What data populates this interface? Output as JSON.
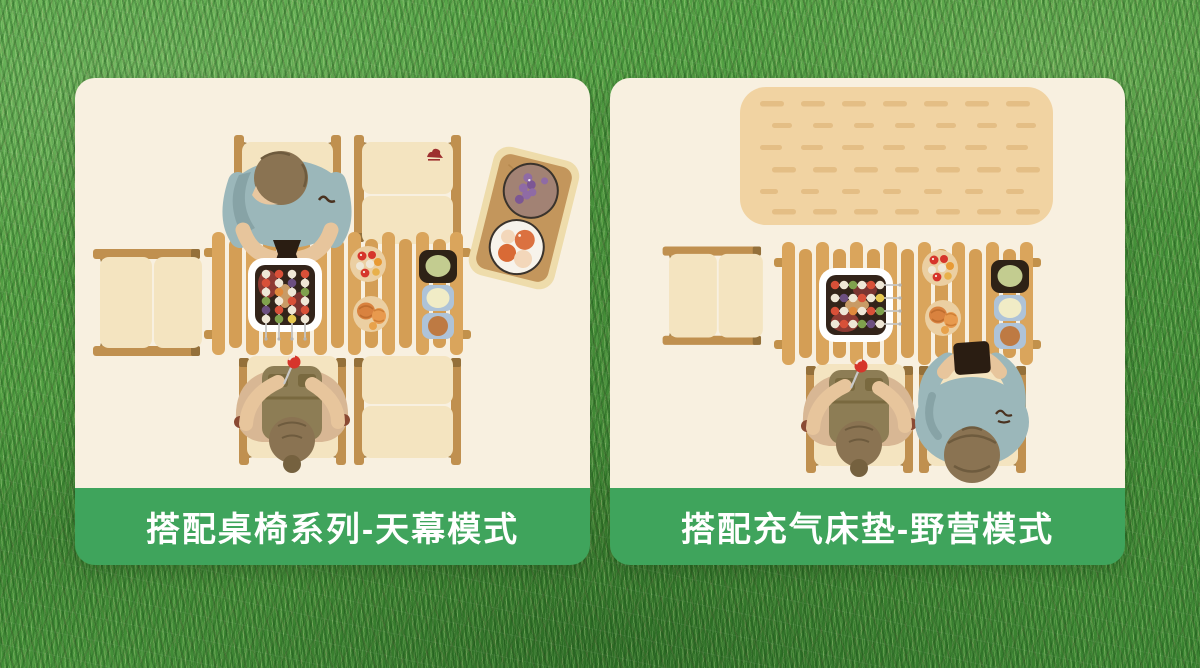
{
  "cards": [
    {
      "id": "canopy-mode",
      "caption": "搭配桌椅系列-天幕模式",
      "scene_items": [
        "occupied-camp-chair-top",
        "empty-camp-chair-top-right",
        "side-folding-chair",
        "slatted-camp-table",
        "bbq-grill-skewers",
        "cherry-tomato-plate",
        "bread-plate",
        "side-dish-trio",
        "wooden-tray-grapes-oranges",
        "diner-with-fork",
        "empty-camp-chair-bottom-right",
        "camel-logo"
      ]
    },
    {
      "id": "camping-mode",
      "caption": "搭配充气床垫-野营模式",
      "scene_items": [
        "inflatable-mattress",
        "side-folding-chair",
        "slatted-camp-table",
        "bbq-grill-skewers",
        "cherry-tomato-plate",
        "bread-plate",
        "side-dish-trio",
        "diner-with-fork",
        "person-using-phone",
        "camel-logo"
      ]
    }
  ],
  "colors": {
    "banner_green": "#3FA45C",
    "panel_cream": "#F8F0E0",
    "grass_green": "#4E9C40",
    "wood_light": "#DAA55C",
    "wood_dark": "#C0904F",
    "cushion": "#F4E4C0",
    "mattress_tan": "#F1D3A2",
    "shirt_blue": "#9BB7BA",
    "vest_khaki": "#8D7D55",
    "skin": "#E7C59C",
    "hair_brown": "#8A7352",
    "grill_black": "#33241A",
    "tomato_red": "#D6352B"
  }
}
